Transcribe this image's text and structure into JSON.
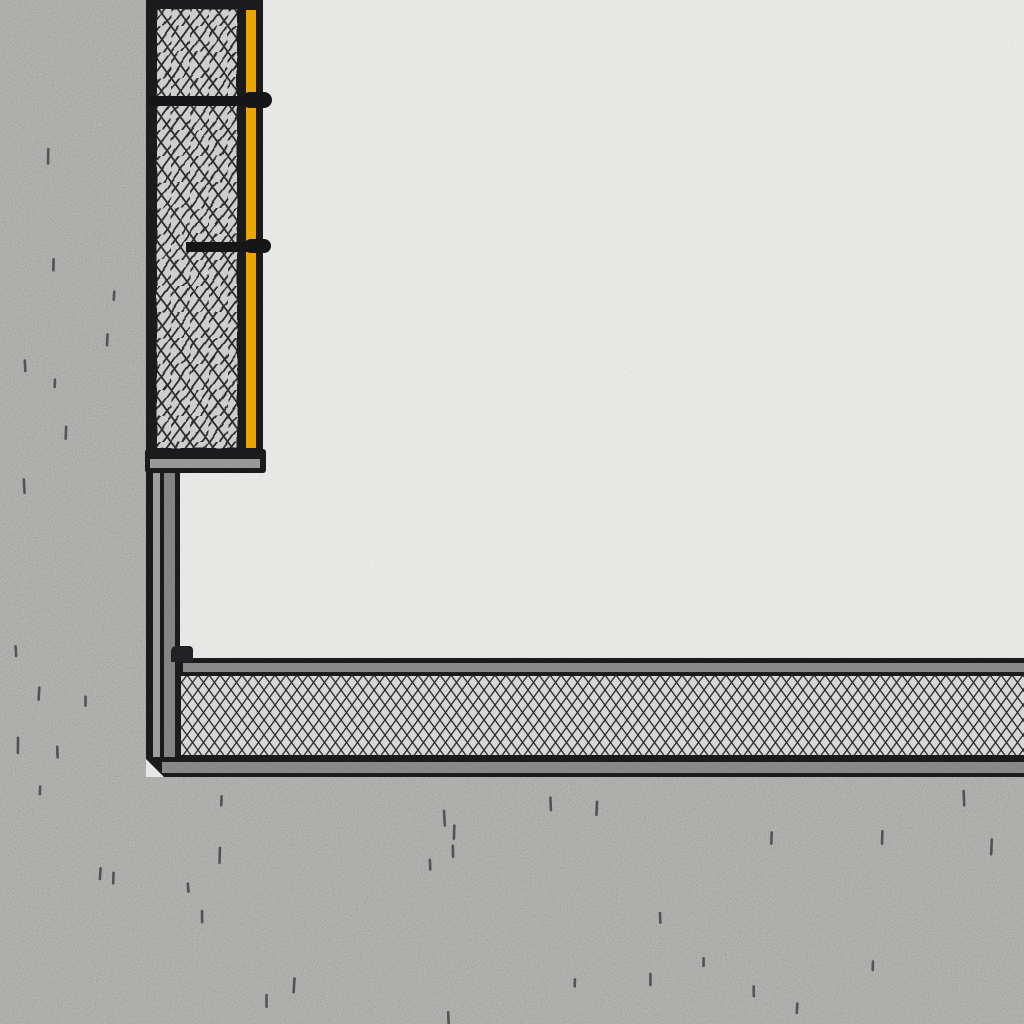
{
  "scene": {
    "kind": "architectural-section-detail",
    "palette": {
      "interior": "#f1f1ef",
      "concrete": "#c7c7c5",
      "outline": "#1d1d1f",
      "hatch_line": "#2e2e2e",
      "panel_hatch_bg": "#d7d7d5",
      "floor_hatch_bg": "#e0e0de",
      "profile_gray": "#8f8f8f",
      "ledge_gray": "#a0a0a0",
      "layer_light_gray": "#a6a6a6",
      "layer_mid_gray": "#8a8a8a",
      "membrane_yellow": "#f6ac00",
      "anchor_black": "#17171a",
      "seal_block": "#232326"
    }
  },
  "texture": {
    "seed": 7,
    "tick_color": "#4e4e4e",
    "tick_width": 2.6,
    "regions": [
      {
        "name": "wall-speckle-tick",
        "x0": 8,
        "x1": 134,
        "y0": 35,
        "y1": 748,
        "count": 13
      },
      {
        "name": "ground-speckle-tick",
        "x0": 12,
        "x1": 1010,
        "y0": 783,
        "y1": 1012,
        "count": 27
      }
    ]
  }
}
